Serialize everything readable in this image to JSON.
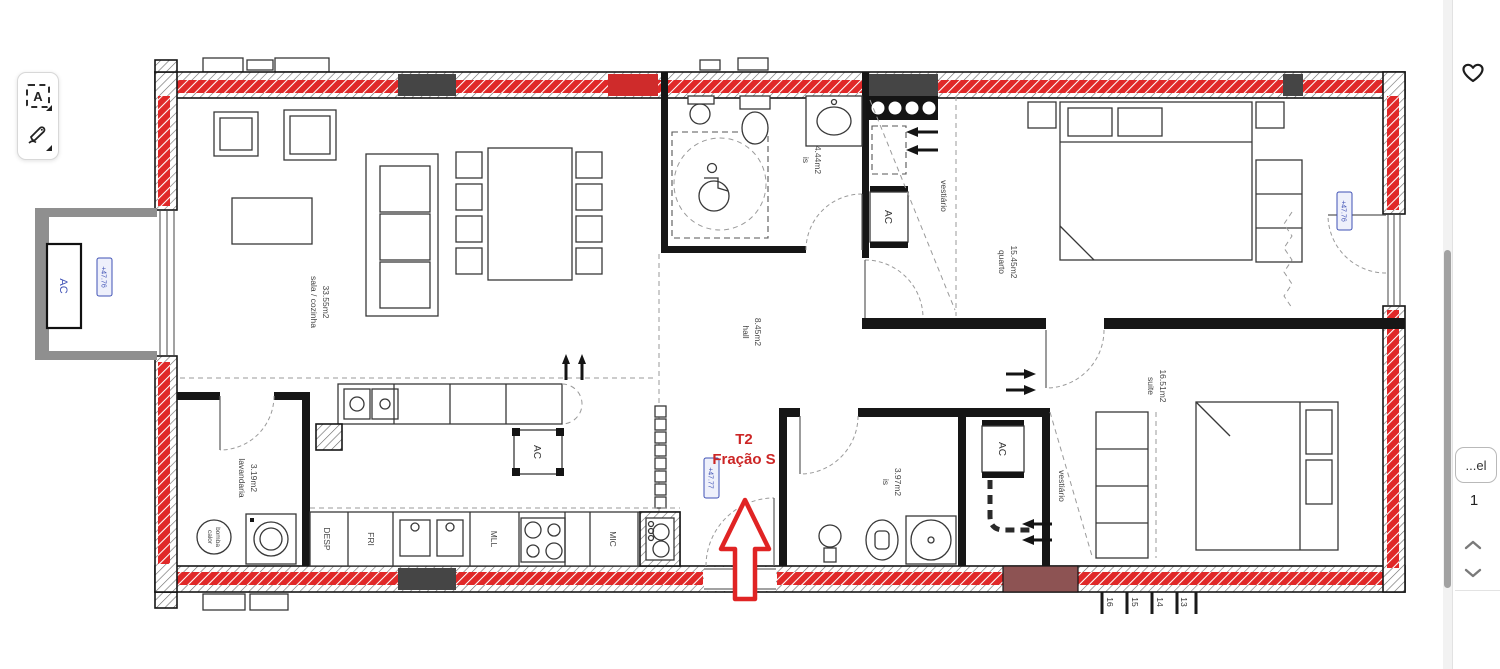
{
  "toolbar": {
    "text_tool_label": "A"
  },
  "right_panel": {
    "truncated_button_label": "...el",
    "page_number": "1"
  },
  "icons": {
    "text_select_tool": "dashed-box-A",
    "draw_tool": "pen",
    "favorite": "heart-outline",
    "scroll_up": "chevron-up",
    "scroll_down": "chevron-down"
  },
  "colors": {
    "wall_highlight_red": "#e02828",
    "annotation_blue": "#3f51b5",
    "unit_label_red": "#cc2626",
    "wall_dark": "#161616"
  },
  "plan": {
    "unit_label": {
      "line1": "T2",
      "line2": "Fração S"
    },
    "levels": {
      "balcony_left": "+47.76",
      "hall": "+47.77",
      "facade_right": "+47.76"
    },
    "rooms": {
      "sala": {
        "name": "sala / cozinha",
        "area": "33.55m2"
      },
      "lavandaria": {
        "name": "lavandaria",
        "area": "3.19m2"
      },
      "hall": {
        "name": "hall",
        "area": "8.45m2"
      },
      "is_top": {
        "name": "is",
        "area": "4.44m2"
      },
      "vestiario_top": {
        "name": "vestiário"
      },
      "quarto": {
        "name": "quarto",
        "area": "15.45m2"
      },
      "suite": {
        "name": "suite",
        "area": "16.51m2"
      },
      "is_bottom": {
        "name": "is",
        "area": "3.97m2"
      },
      "vestiario_bottom": {
        "name": "vestiário"
      }
    },
    "equipment": {
      "ac": "AC",
      "heat_pump_line1": "bomba",
      "heat_pump_line2": "calor",
      "pantry": "DESP",
      "fridge": "FRI",
      "dishwasher": "MLL",
      "microwave": "MIC"
    },
    "stair_steps": [
      "16",
      "15",
      "14",
      "13"
    ]
  }
}
